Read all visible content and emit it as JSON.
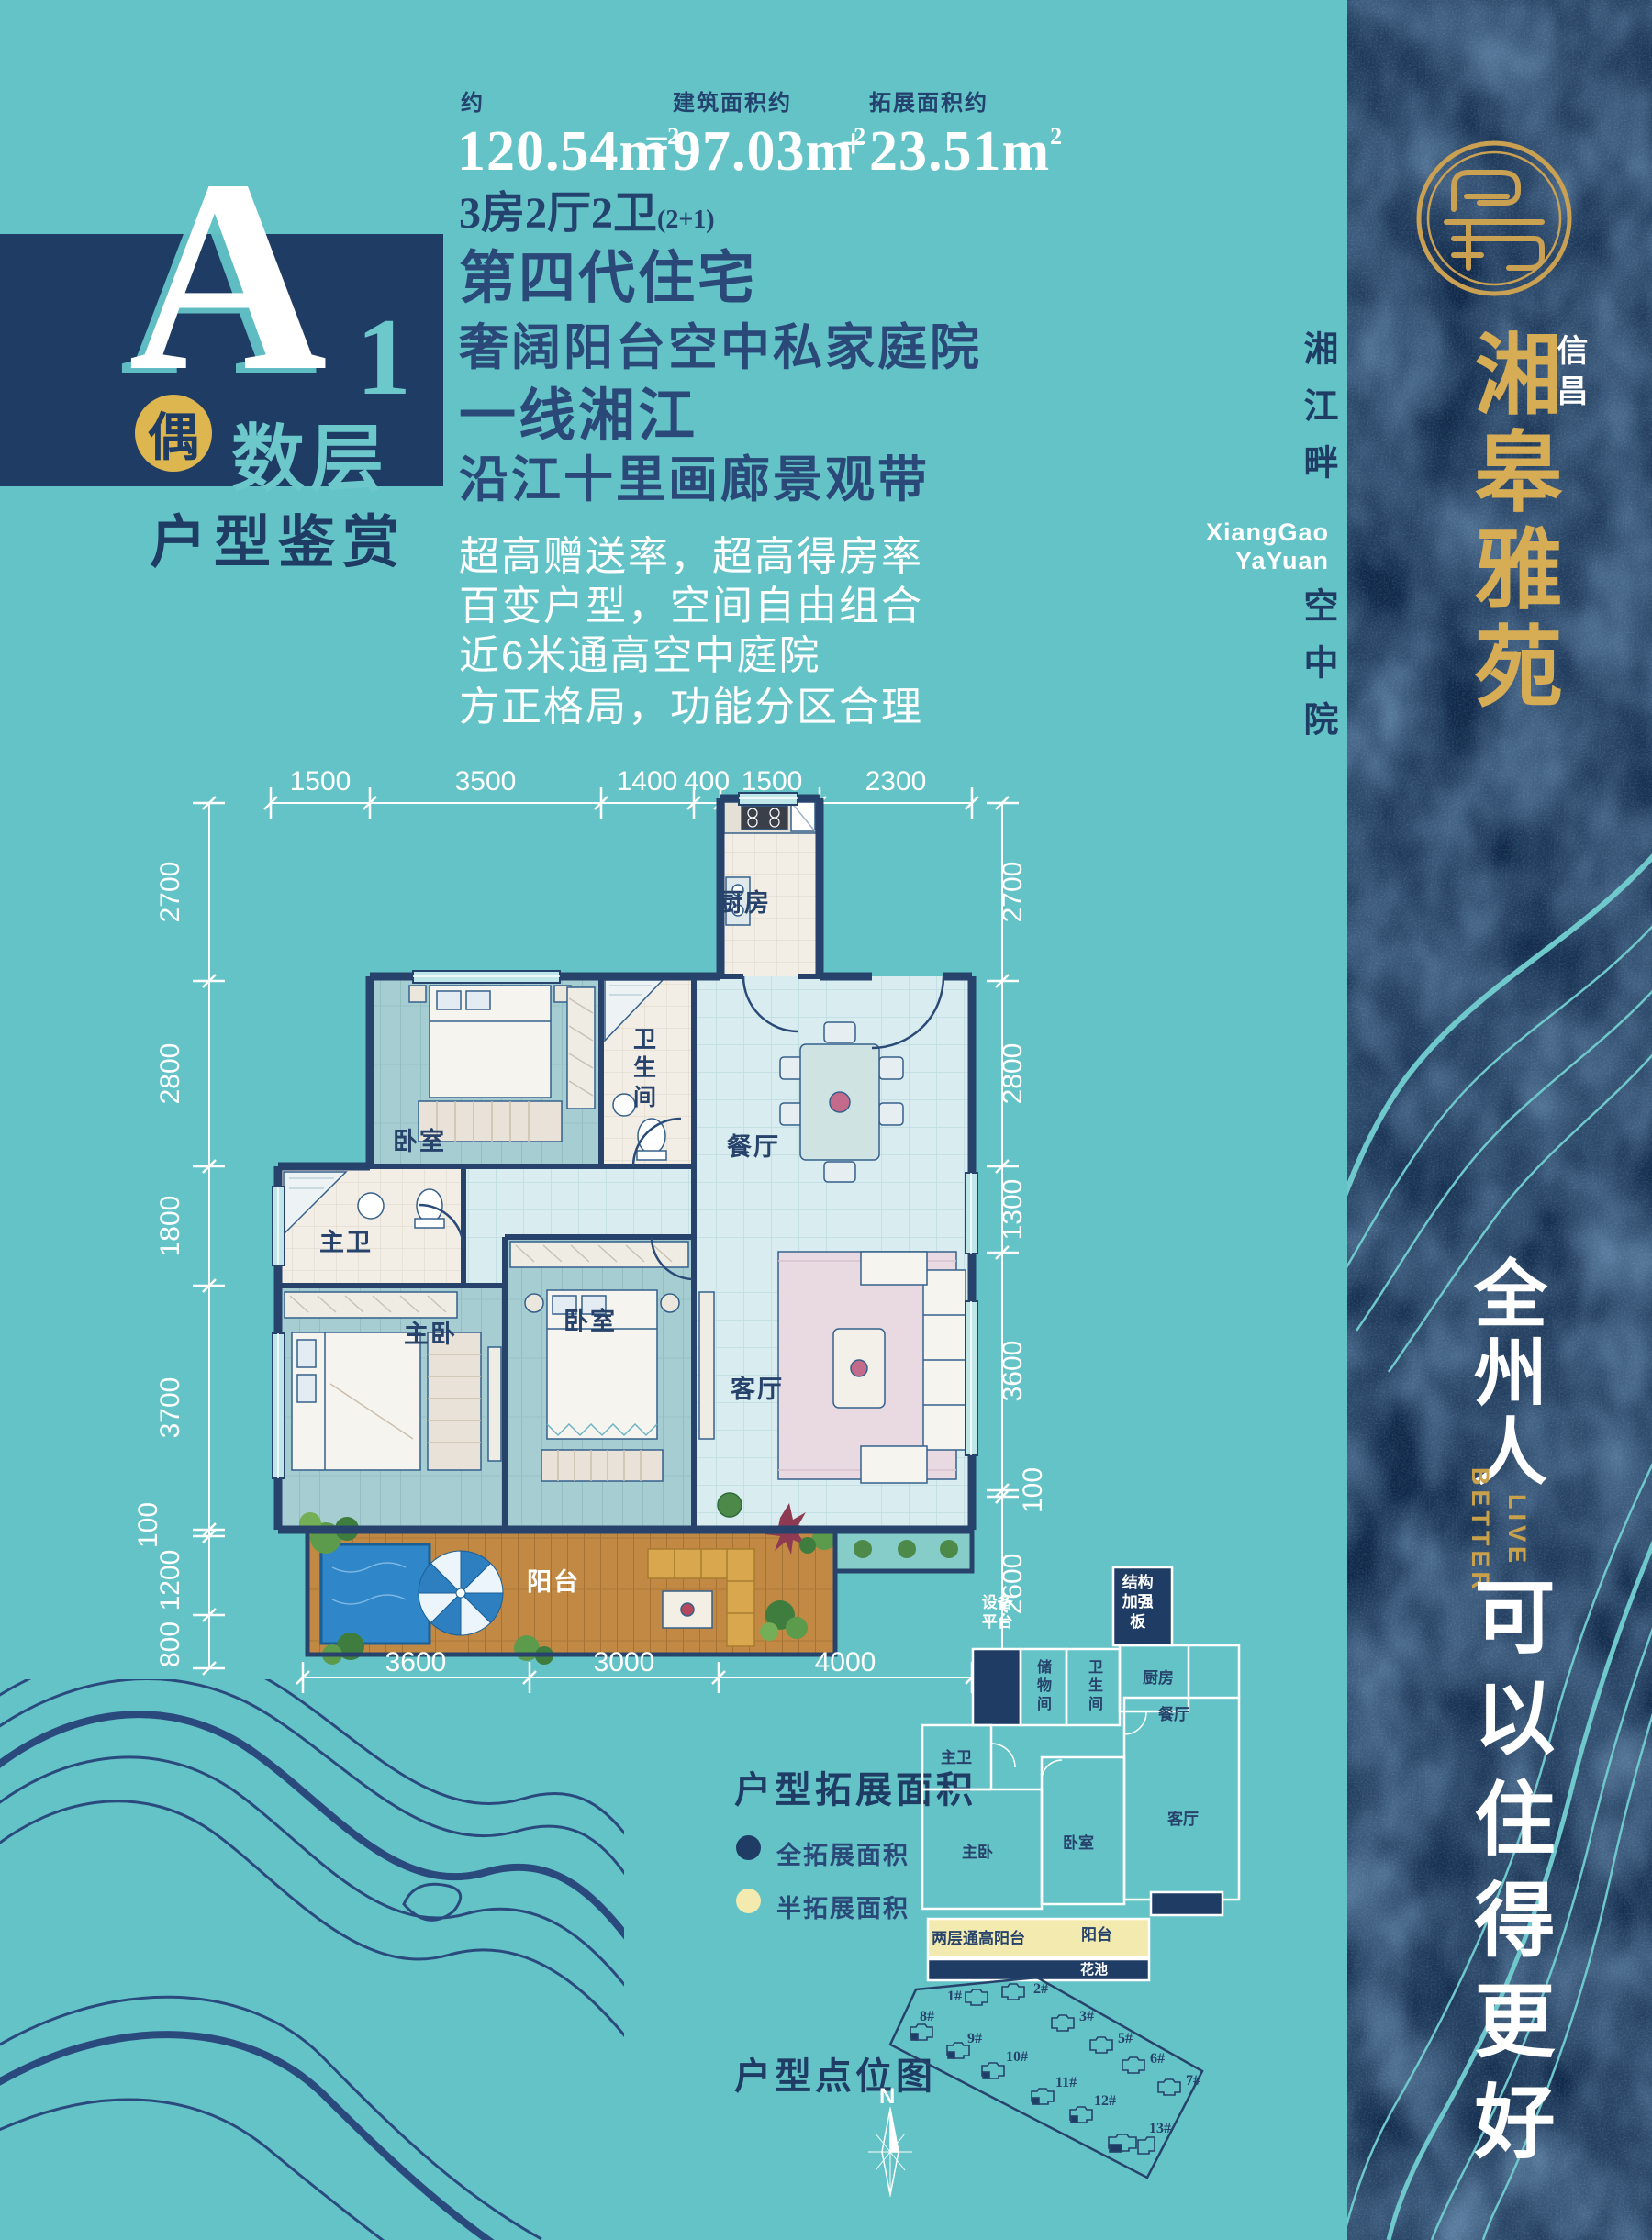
{
  "header": {
    "approx_label": "约",
    "total_area": "120.54m",
    "sup": "2",
    "equals": "=",
    "built_label": "建筑面积约",
    "built_area": "97.03m",
    "plus": "+",
    "expand_label": "拓展面积约",
    "expand_area": "23.51m",
    "layout": "3房2厅2卫",
    "layout_note": "(2+1)"
  },
  "unit_block": {
    "letter": "A",
    "number": "1",
    "badge": "偶",
    "floors": "数层",
    "subtitle": "户型鉴赏"
  },
  "headlines": [
    "第四代住宅",
    "奢阔阳台空中私家庭院",
    "一线湘江",
    "沿江十里画廊景观带"
  ],
  "features": [
    "超高赠送率，超高得房率",
    "百变户型，空间自由组合",
    "近6米通高空中庭院",
    "方正格局，功能分区合理"
  ],
  "plan": {
    "dims_top": [
      "1500",
      "3500",
      "1400",
      "400",
      "1500",
      "2300"
    ],
    "dims_left": [
      "2700",
      "2800",
      "1800",
      "3700",
      "100",
      "1200",
      "800"
    ],
    "dims_right": [
      "2700",
      "2800",
      "1300",
      "3600",
      "100",
      "2600"
    ],
    "dims_bottom": [
      "3600",
      "3000",
      "4000"
    ],
    "rooms": {
      "kitchen": "厨房",
      "bathroom": "卫生间",
      "dining": "餐厅",
      "bedroom1": "卧室",
      "master_bath": "主卫",
      "master_bedroom": "主卧",
      "bedroom2": "卧室",
      "living": "客厅",
      "balcony": "阳台"
    }
  },
  "expansion": {
    "title": "户型拓展面积",
    "legend_full": "全拓展面积",
    "legend_half": "半拓展面积",
    "colors": {
      "full": "#1e3c64",
      "half": "#f2eaae"
    },
    "rooms": {
      "structure_plate": "结构加强板",
      "equipment": "设备平台",
      "storage": "储物间",
      "bathroom": "卫生间",
      "kitchen": "厨房",
      "dining": "餐厅",
      "master_bath": "主卫",
      "master_bedroom": "主卧",
      "bedroom": "卧室",
      "living": "客厅",
      "double_balcony": "两层通高阳台",
      "balcony": "阳台",
      "flower_bed": "花池"
    }
  },
  "site": {
    "title": "户型点位图",
    "compass": "N",
    "buildings": [
      "1#",
      "2#",
      "3#",
      "5#",
      "6#",
      "7#",
      "8#",
      "9#",
      "10#",
      "11#",
      "12#",
      "13#"
    ]
  },
  "brand": {
    "company": "信昌",
    "name": "湘皋雅苑",
    "side_line1": "湘江畔",
    "side_line2": "空中院",
    "romanized_line1": "XiangGao",
    "romanized_line2": "YaYuan",
    "slogan_cn_top": "全州人",
    "slogan_en_line1": "LIVE",
    "slogan_en_line2": "BETTER",
    "slogan_cn_bottom": "可以住得更好"
  }
}
